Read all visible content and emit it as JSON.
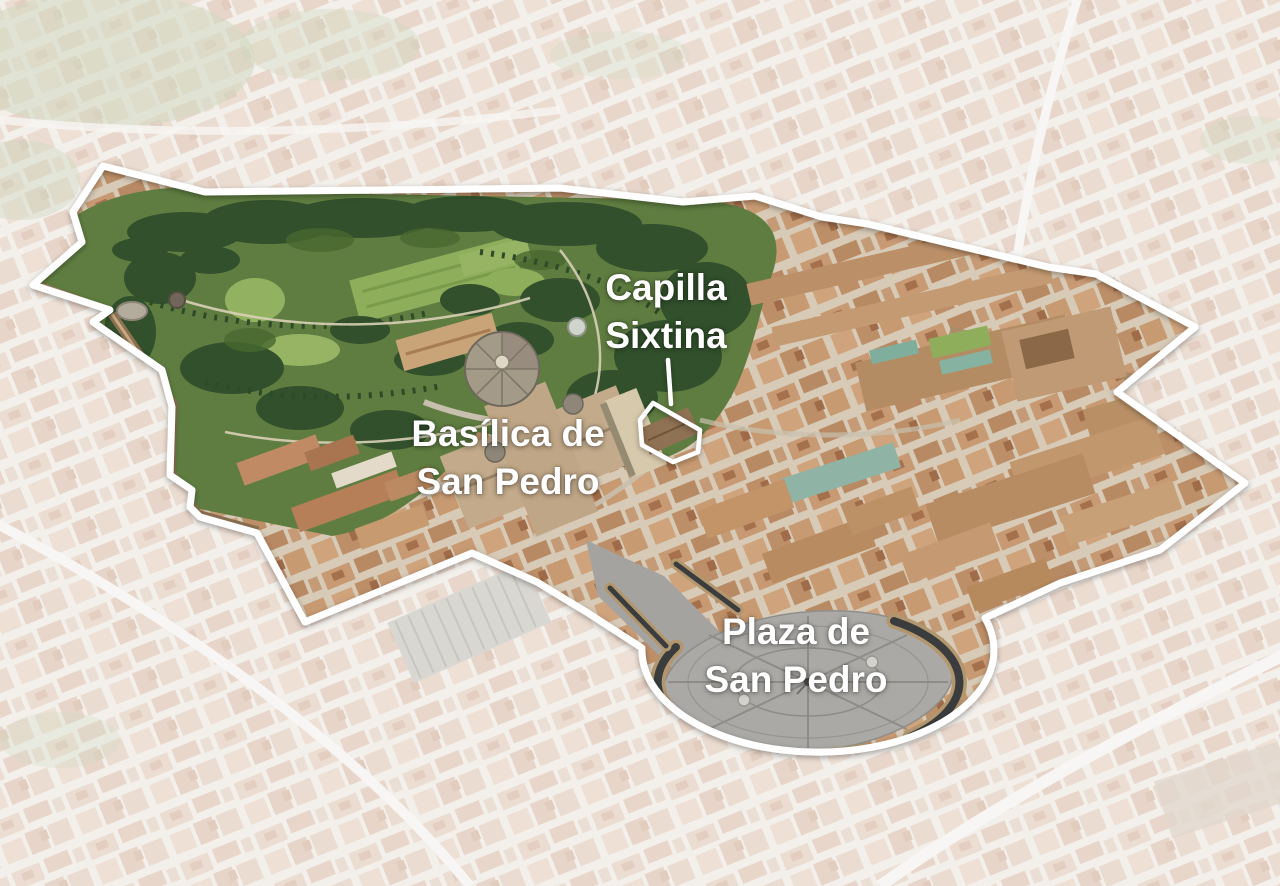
{
  "map": {
    "annotations": [
      {
        "id": "capilla-sixtina",
        "line1": "Capilla",
        "line2": "Sixtina"
      },
      {
        "id": "basilica-de-san-pedro",
        "line1": "Basílica de",
        "line2": "San Pedro"
      },
      {
        "id": "plaza-de-san-pedro",
        "line1": "Plaza de",
        "line2": "San Pedro"
      }
    ],
    "colors": {
      "annotation_text": "#ffffff",
      "boundary_outline": "#ffffff",
      "gardens_green": "#5f7d41",
      "rooftop_terracotta": "#bb8a64",
      "plaza_paving": "#aaa9a5",
      "faded_city": "#e8e2da"
    }
  }
}
